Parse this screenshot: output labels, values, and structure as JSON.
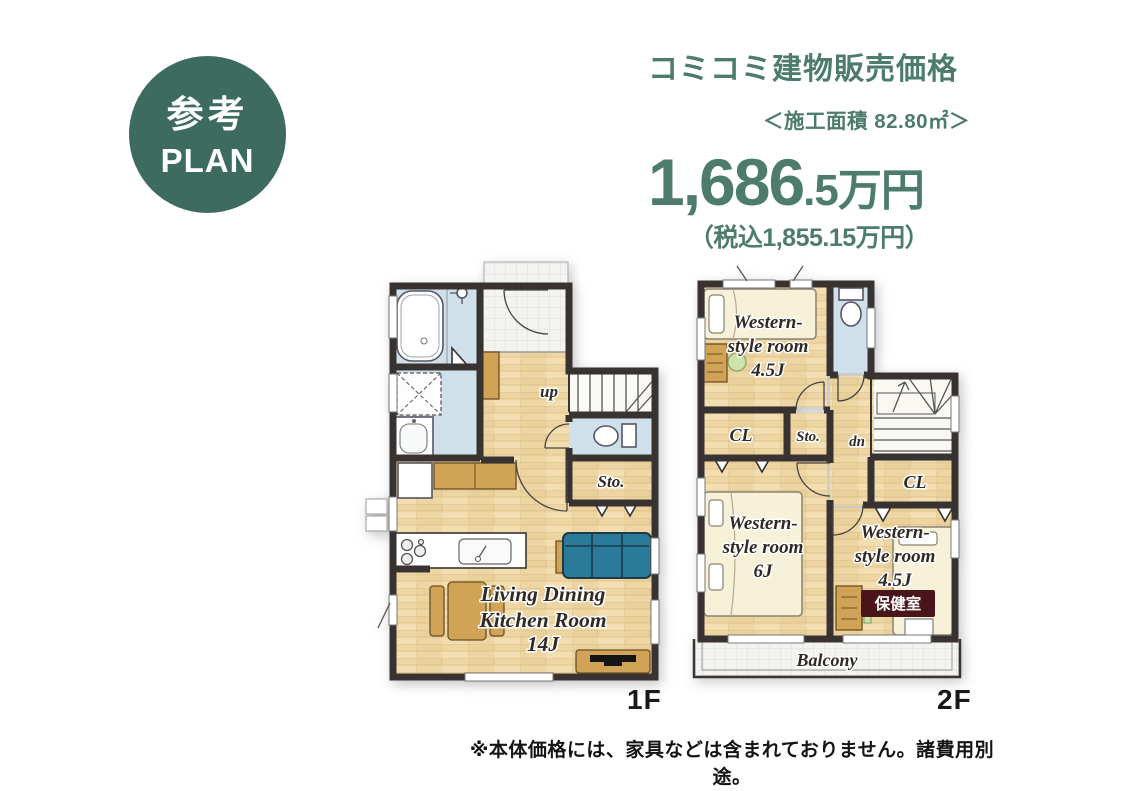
{
  "badge": {
    "line1": "参考",
    "line2": "PLAN"
  },
  "price_block": {
    "title": "コミコミ建物販売価格",
    "area": "＜施工面積 82.80㎡＞",
    "price_main": "1,686",
    "price_suffix": ".5万円",
    "price_tax": "（税込1,855.15万円）"
  },
  "floor1": {
    "floor_label": "1F",
    "labels": {
      "up": "up",
      "storage": "Sto.",
      "ldk_line1": "Living Dining",
      "ldk_line2": "Kitchen Room",
      "ldk_line3": "14J"
    }
  },
  "floor2": {
    "floor_label": "2F",
    "labels": {
      "down": "dn",
      "closet_left": "CL",
      "storage": "Sto.",
      "closet_right": "CL",
      "room_a_line1": "Western-",
      "room_a_line2": "style room",
      "room_a_line3": "4.5J",
      "room_b_line1": "Western-",
      "room_b_line2": "style room",
      "room_b_line3": "6J",
      "room_c_line1": "Western-",
      "room_c_line2": "style room",
      "room_c_line3": "4.5J",
      "room_c_tag": "保健室",
      "balcony": "Balcony"
    }
  },
  "footer": {
    "note": "※本体価格には、家具などは含まれておりません。諸費用別途。"
  },
  "colors": {
    "accent": "#4d7b6c",
    "badge": "#3e6b5f",
    "wall": "#383330",
    "wood": "#eed6a4",
    "water": "#cfe0eb",
    "furniture": "#d1a356",
    "sofa": "#2a7b99",
    "bed": "#f7f1da",
    "tag": "#4a151a",
    "text": "#2f2a24"
  }
}
